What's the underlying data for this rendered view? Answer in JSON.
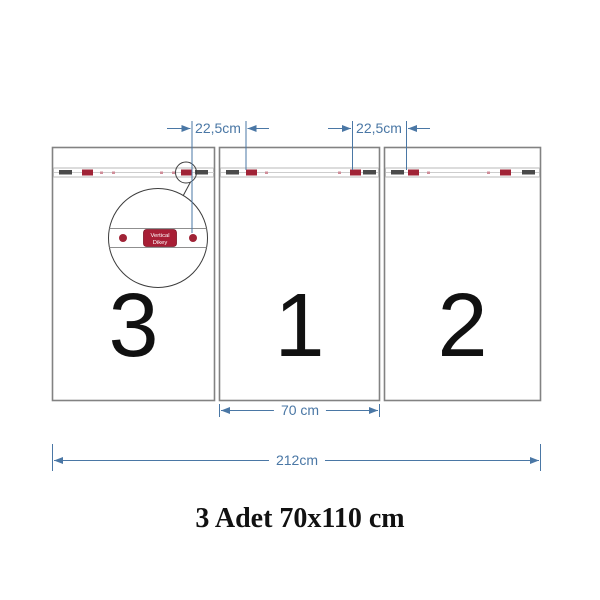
{
  "title": "3 Adet 70x110 cm",
  "panels": [
    {
      "number": "3"
    },
    {
      "number": "1"
    },
    {
      "number": "2"
    }
  ],
  "dimensions": {
    "clip_gap_left": "22,5cm",
    "clip_gap_right": "22,5cm",
    "panel_width": "70 cm",
    "total_width": "212cm"
  },
  "detail": {
    "label_line1": "Vertical",
    "label_line2": "Dikey"
  },
  "colors": {
    "dimension_blue": "#4a77a5",
    "panel_border_gray": "#828282",
    "strip_border_gray": "#b8b8b8",
    "clip_dark": "#4a4a4a",
    "clip_red": "#a02336",
    "label_red_bg": "#a81e35",
    "text_black": "#111111"
  }
}
